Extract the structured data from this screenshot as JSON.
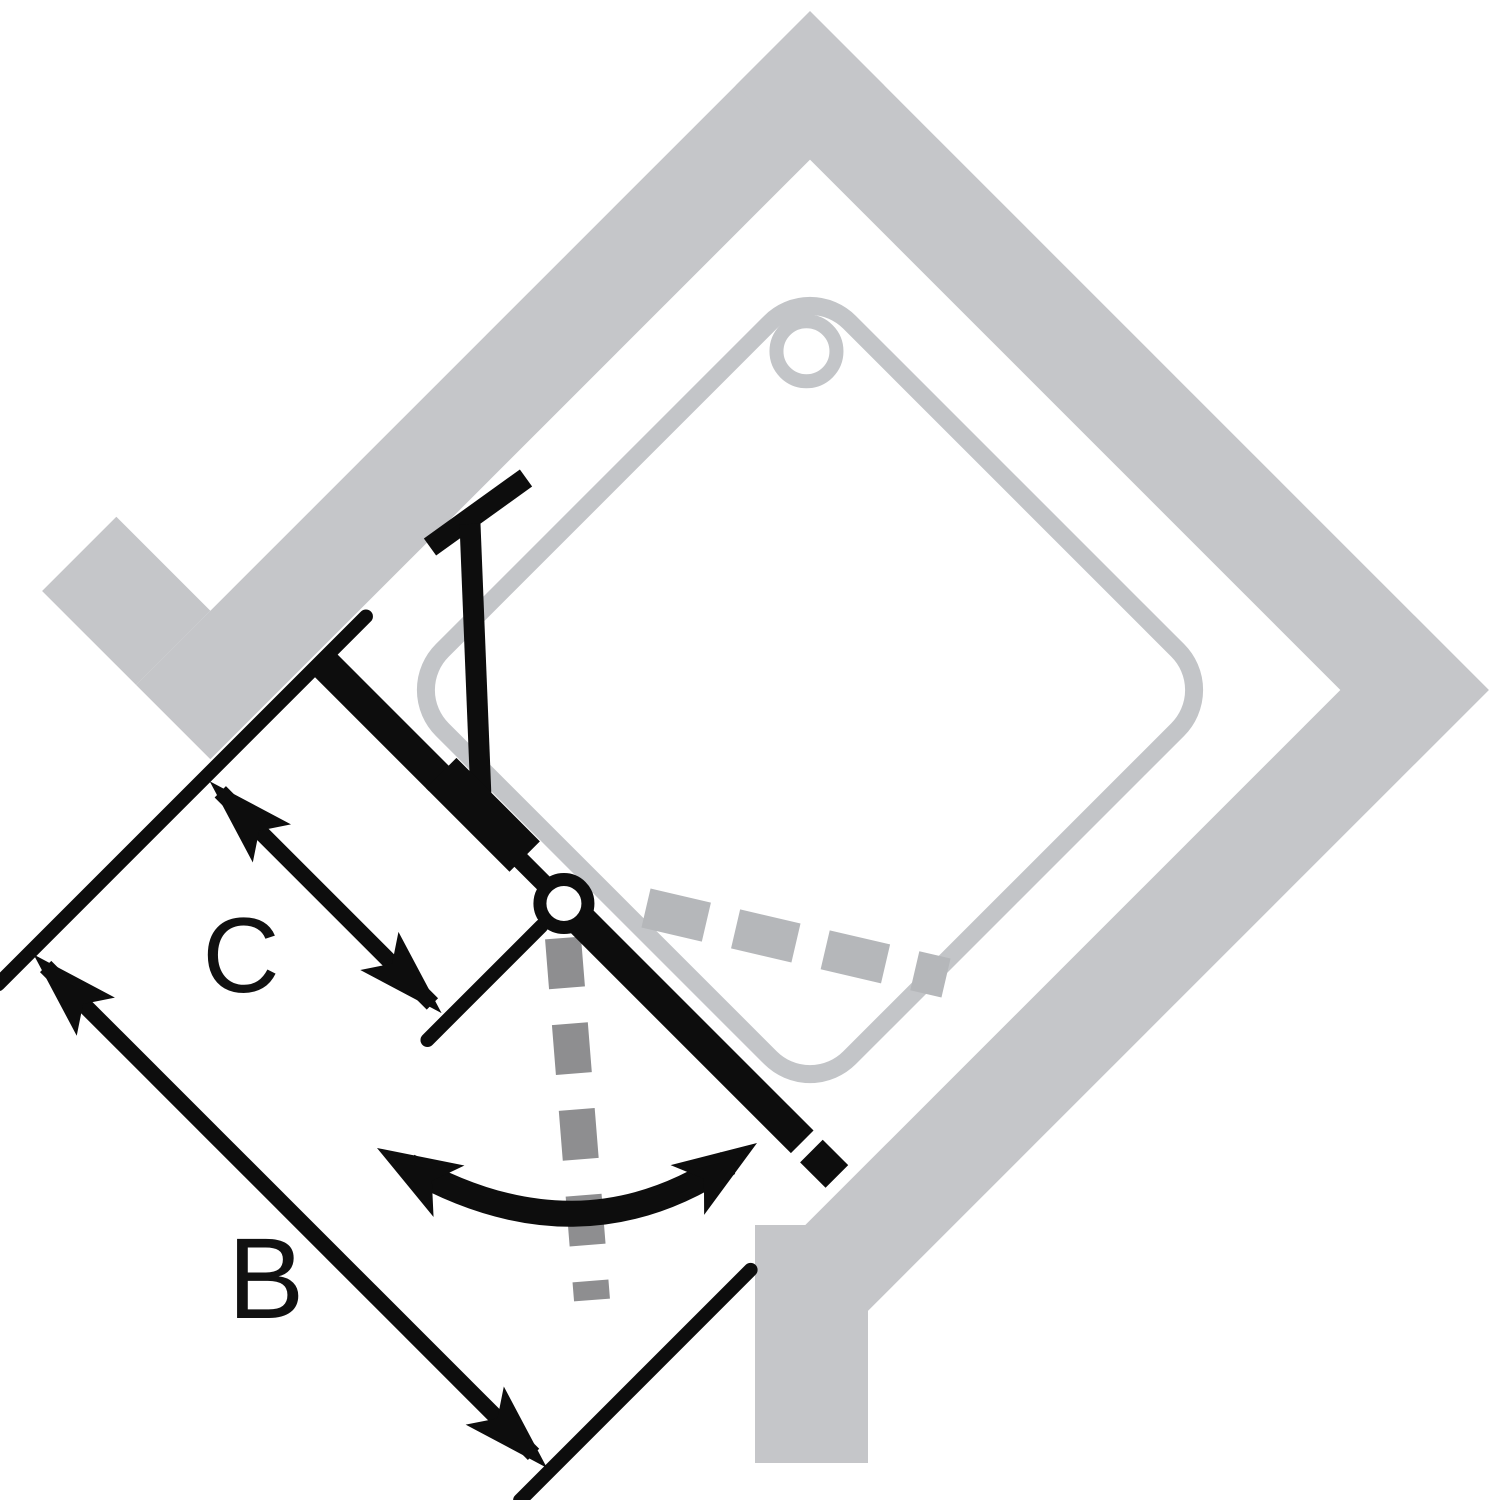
{
  "diagram": {
    "type": "shower-enclosure-corner-entry-plan",
    "labels": {
      "overall_width": "B",
      "fixed_panel_width": "C"
    },
    "colors": {
      "background": "#ffffff",
      "wall": "#c5c6c9",
      "tray": "#c3c5c8",
      "ink": "#0d0d0d",
      "swing_outward_dash": "#8e8e90",
      "swing_inward_dash": "#b5b7ba",
      "label": "#111111"
    }
  }
}
